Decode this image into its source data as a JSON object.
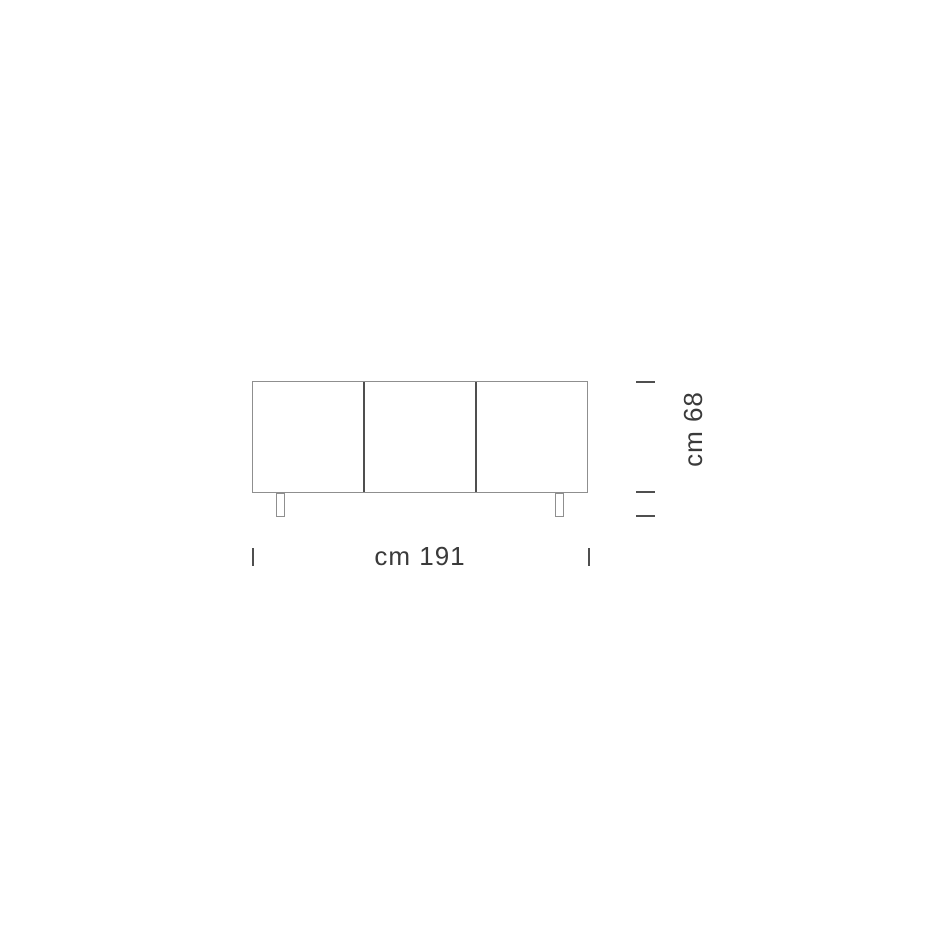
{
  "diagram": {
    "kind": "furniture-dimension-drawing",
    "view": "front",
    "door_count": 3,
    "leg_count": 2,
    "dimensions": {
      "width_label": "cm 191",
      "height_label": "cm 68"
    },
    "colors": {
      "background": "#ffffff",
      "outline": "#8f8f8f",
      "divider": "#4f4f4f",
      "tick": "#4f4f4f",
      "text": "#3a3a3a"
    }
  }
}
